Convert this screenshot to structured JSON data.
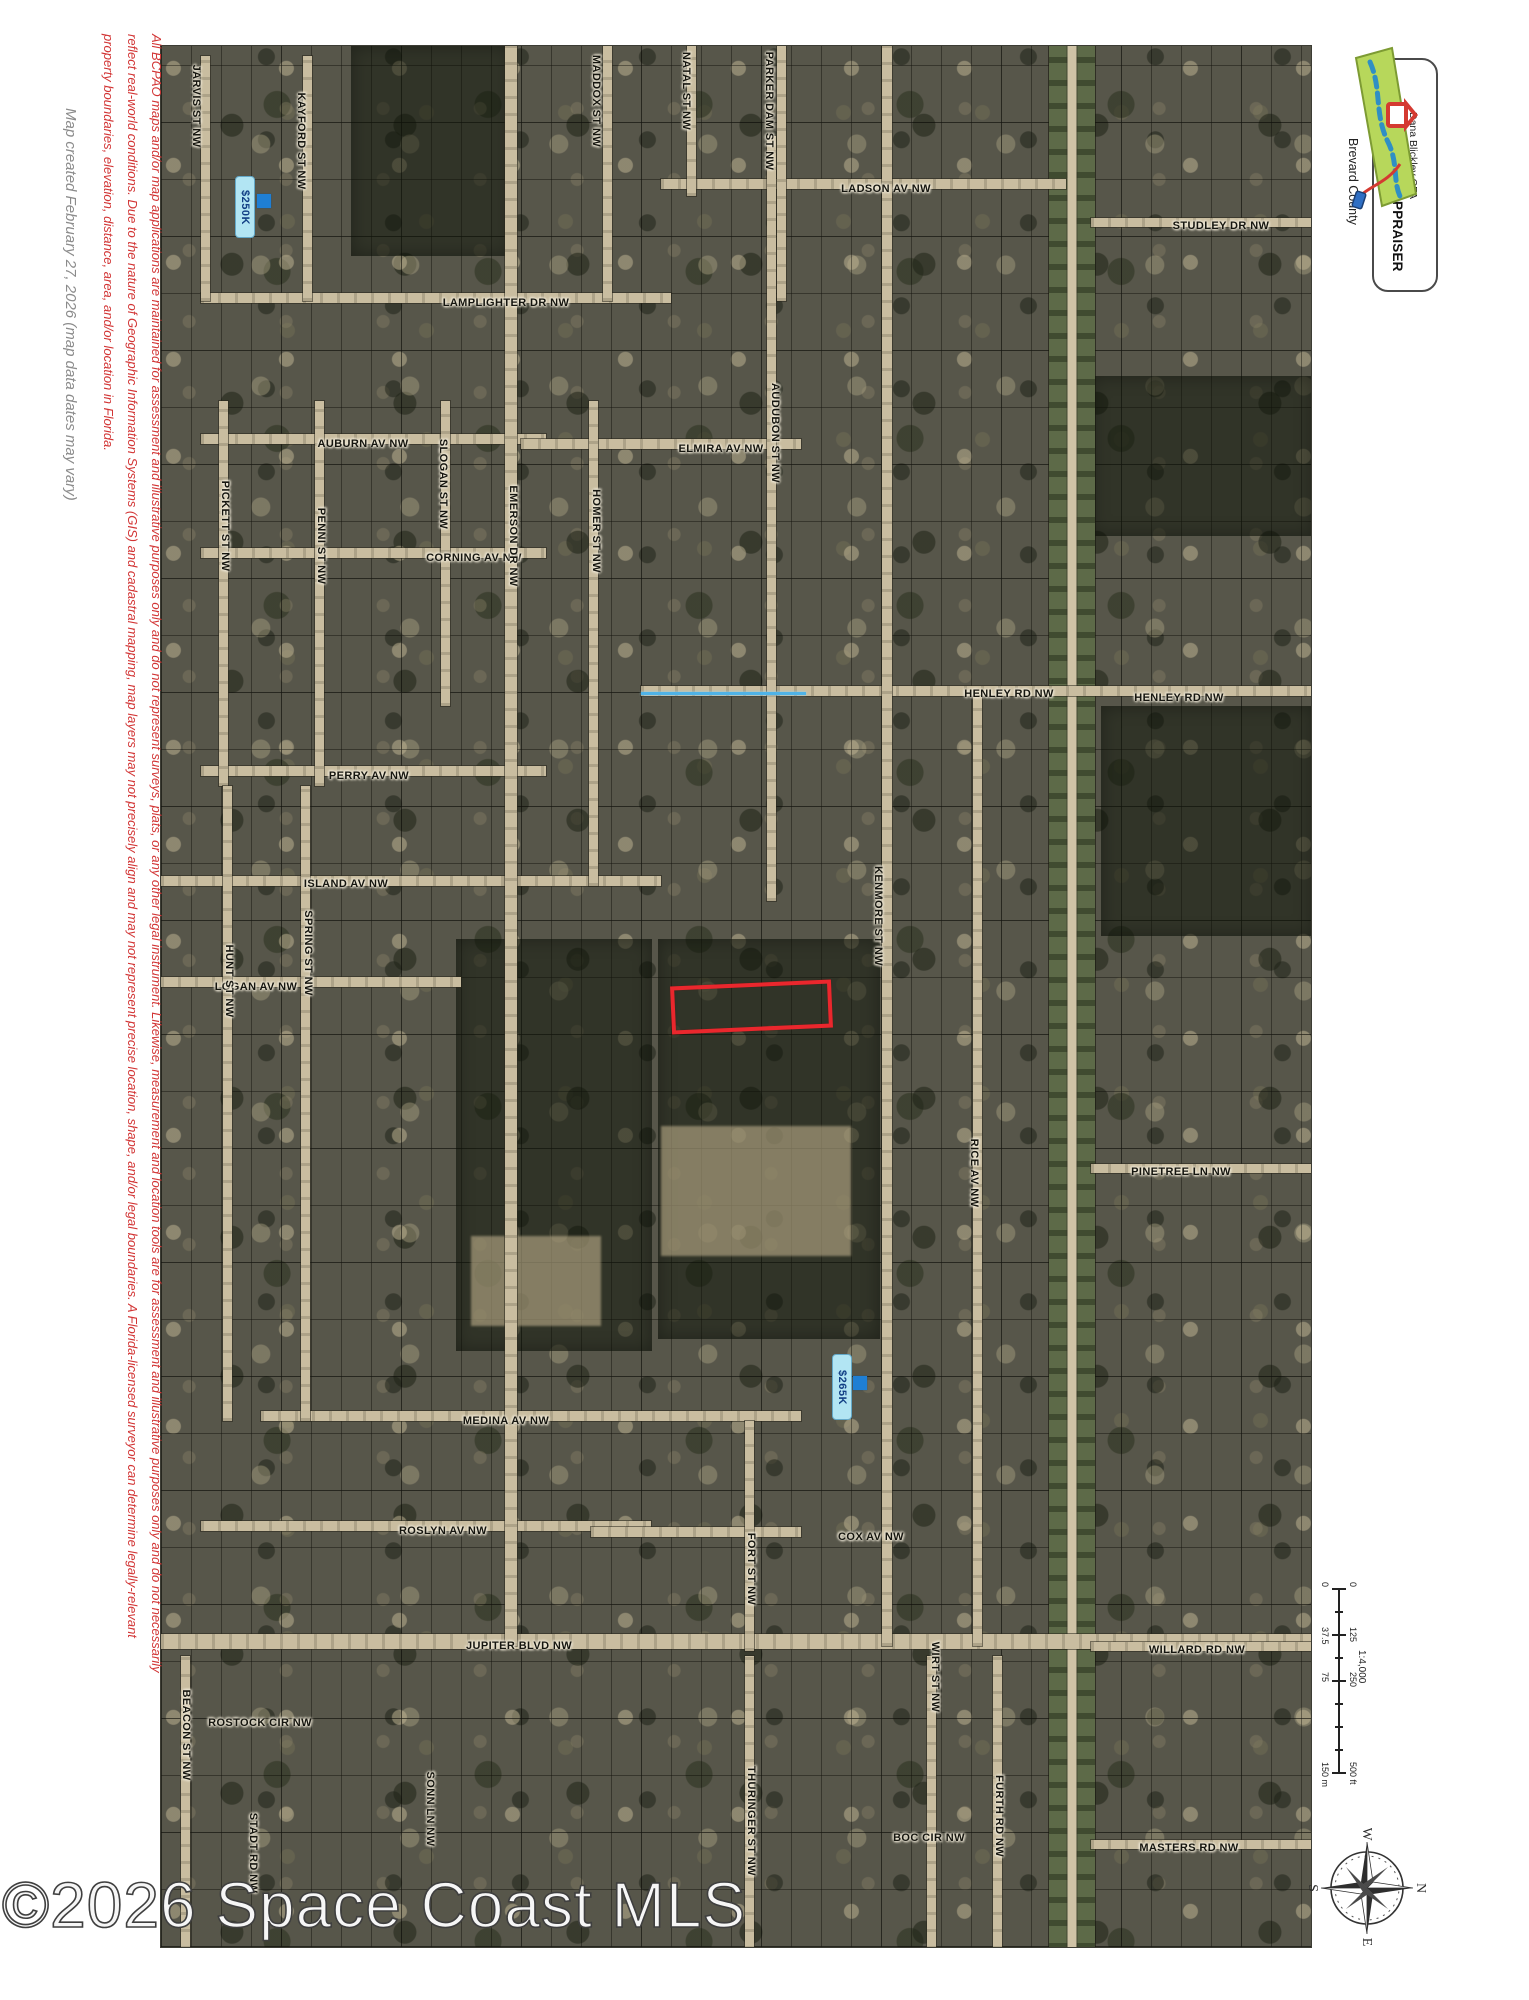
{
  "watermark": "©2026 Space Coast MLS",
  "left_margin": {
    "map_created": "Map created February 27, 2026 (map data dates may vary)",
    "disclaimer": "All BCPAO maps and/or map applications are maintained for assessment and illustrative purposes only and do not represent surveys, plats, or any other legal instrument. Likewise, measurement and location tools are for assessment and illustrative purposes only and do not necessarily reflect real-world conditions. Due to the nature of Geographic Information Systems (GIS) and cadastral mapping, map layers may not precisely align and may not represent precise location, shape, and/or legal boundaries. A Florida-licensed surveyor can determine legally-relevant property boundaries, elevation, distance, area, and/or location in Florida."
  },
  "logo": {
    "name_line": "Dana Blickley CFA",
    "title_line": "PROPERTY APPRAISER",
    "county_line": "Brevard County"
  },
  "scale_bar": {
    "ratio": "1:4,000",
    "feet_labels": [
      "0",
      "125",
      "250",
      "500 ft"
    ],
    "meter_labels": [
      "0",
      "37.5",
      "75",
      "150 m"
    ],
    "label_offsets": [
      0,
      45,
      90,
      180
    ]
  },
  "compass": {
    "north": "N",
    "east": "E",
    "south": "S",
    "west": "W"
  },
  "map": {
    "subject_parcel": {
      "x": 510,
      "y": 937,
      "w": 153,
      "h": 40,
      "color": "#ea272d"
    },
    "waterway": {
      "x": 480,
      "y": 646,
      "len": 165,
      "color": "#4fb3e8"
    },
    "price_markers": [
      {
        "label": "$250K",
        "x": 74,
        "y": 130,
        "w": 18,
        "h": 60,
        "dot_x": 96,
        "dot_y": 148,
        "dot_s": 14
      },
      {
        "label": "$265K",
        "x": 671,
        "y": 1308,
        "w": 18,
        "h": 64,
        "dot_x": 692,
        "dot_y": 1330,
        "dot_s": 14
      }
    ],
    "street_labels_horizontal": [
      {
        "text": "LADSON AV NW",
        "x": 725,
        "y": 143
      },
      {
        "text": "STUDLEY DR NW",
        "x": 1060,
        "y": 180
      },
      {
        "text": "LAMPLIGHTER DR NW",
        "x": 345,
        "y": 257
      },
      {
        "text": "AUBURN AV NW",
        "x": 202,
        "y": 398
      },
      {
        "text": "ELMIRA AV NW",
        "x": 560,
        "y": 403
      },
      {
        "text": "CORNING AV NW",
        "x": 313,
        "y": 512
      },
      {
        "text": "HENLEY RD NW",
        "x": 848,
        "y": 648
      },
      {
        "text": "HENLEY RD NW",
        "x": 1018,
        "y": 652
      },
      {
        "text": "PERRY AV NW",
        "x": 208,
        "y": 730
      },
      {
        "text": "ISLAND AV NW",
        "x": 185,
        "y": 838
      },
      {
        "text": "LOGAN AV NW",
        "x": 95,
        "y": 941
      },
      {
        "text": "PINETREE LN NW",
        "x": 1020,
        "y": 1126
      },
      {
        "text": "MEDINA AV NW",
        "x": 345,
        "y": 1375
      },
      {
        "text": "ROSLYN AV NW",
        "x": 282,
        "y": 1485
      },
      {
        "text": "COX AV NW",
        "x": 710,
        "y": 1491
      },
      {
        "text": "JUPITER BLVD NW",
        "x": 358,
        "y": 1600
      },
      {
        "text": "WILLARD RD NW",
        "x": 1036,
        "y": 1604
      },
      {
        "text": "ROSTOCK CIR NW",
        "x": 99,
        "y": 1677
      },
      {
        "text": "BOC CIR NW",
        "x": 768,
        "y": 1792
      },
      {
        "text": "MASTERS RD NW",
        "x": 1028,
        "y": 1802
      }
    ],
    "street_labels_vertical": [
      {
        "text": "JARVIS ST NW",
        "x": 35,
        "y": 60
      },
      {
        "text": "KAYFORD ST NW",
        "x": 140,
        "y": 95
      },
      {
        "text": "MADDOX ST NW",
        "x": 435,
        "y": 55
      },
      {
        "text": "NATAL ST NW",
        "x": 525,
        "y": 45
      },
      {
        "text": "PARKER DAM ST NW",
        "x": 608,
        "y": 65
      },
      {
        "text": "EMERSON DR NW",
        "x": 352,
        "y": 490
      },
      {
        "text": "HOMER ST NW",
        "x": 435,
        "y": 485
      },
      {
        "text": "SLOGAN ST NW",
        "x": 282,
        "y": 438
      },
      {
        "text": "AUDUBON ST NW",
        "x": 614,
        "y": 387
      },
      {
        "text": "PICKETT ST NW",
        "x": 64,
        "y": 480
      },
      {
        "text": "PENNI ST NW",
        "x": 160,
        "y": 500
      },
      {
        "text": "SPRING ST NW",
        "x": 147,
        "y": 907
      },
      {
        "text": "HUNT ST NW",
        "x": 68,
        "y": 935
      },
      {
        "text": "KENMORE ST NW",
        "x": 717,
        "y": 870
      },
      {
        "text": "RICE AV NW",
        "x": 813,
        "y": 1127
      },
      {
        "text": "FORT ST NW",
        "x": 590,
        "y": 1523
      },
      {
        "text": "WIRT ST NW",
        "x": 774,
        "y": 1631
      },
      {
        "text": "THURINGER ST NW",
        "x": 590,
        "y": 1775
      },
      {
        "text": "FURTH RD NW",
        "x": 838,
        "y": 1770
      },
      {
        "text": "BEACON ST NW",
        "x": 25,
        "y": 1689
      },
      {
        "text": "SONN LN NW",
        "x": 269,
        "y": 1763
      },
      {
        "text": "STADT RD NW",
        "x": 92,
        "y": 1807
      }
    ],
    "roads_horizontal": [
      {
        "x": 500,
        "y": 138,
        "len": 405,
        "w": 10
      },
      {
        "x": 930,
        "y": 176,
        "len": 222,
        "w": 9
      },
      {
        "x": 40,
        "y": 252,
        "len": 470,
        "w": 10
      },
      {
        "x": 40,
        "y": 393,
        "len": 345,
        "w": 10
      },
      {
        "x": 360,
        "y": 398,
        "len": 280,
        "w": 10
      },
      {
        "x": 40,
        "y": 507,
        "len": 345,
        "w": 10
      },
      {
        "x": 480,
        "y": 645,
        "len": 672,
        "w": 10
      },
      {
        "x": 40,
        "y": 725,
        "len": 345,
        "w": 10
      },
      {
        "x": 0,
        "y": 835,
        "len": 500,
        "w": 10
      },
      {
        "x": 0,
        "y": 936,
        "len": 300,
        "w": 10
      },
      {
        "x": 930,
        "y": 1122,
        "len": 222,
        "w": 9
      },
      {
        "x": 100,
        "y": 1370,
        "len": 540,
        "w": 10
      },
      {
        "x": 40,
        "y": 1480,
        "len": 450,
        "w": 10
      },
      {
        "x": 430,
        "y": 1486,
        "len": 210,
        "w": 10
      },
      {
        "x": 0,
        "y": 1595,
        "len": 1152,
        "w": 15
      },
      {
        "x": 930,
        "y": 1600,
        "len": 222,
        "w": 9
      },
      {
        "x": 930,
        "y": 1798,
        "len": 222,
        "w": 9
      }
    ],
    "roads_vertical": [
      {
        "x": 44,
        "y": 10,
        "len": 245,
        "w": 9
      },
      {
        "x": 146,
        "y": 10,
        "len": 245,
        "w": 9
      },
      {
        "x": 446,
        "y": 0,
        "len": 255,
        "w": 9
      },
      {
        "x": 530,
        "y": 0,
        "len": 150,
        "w": 9
      },
      {
        "x": 620,
        "y": 0,
        "len": 255,
        "w": 9
      },
      {
        "x": 350,
        "y": 0,
        "len": 1600,
        "w": 12
      },
      {
        "x": 432,
        "y": 355,
        "len": 485,
        "w": 9
      },
      {
        "x": 284,
        "y": 355,
        "len": 305,
        "w": 9
      },
      {
        "x": 62,
        "y": 355,
        "len": 385,
        "w": 9
      },
      {
        "x": 158,
        "y": 355,
        "len": 385,
        "w": 9
      },
      {
        "x": 610,
        "y": 90,
        "len": 765,
        "w": 9
      },
      {
        "x": 144,
        "y": 740,
        "len": 635,
        "w": 9
      },
      {
        "x": 66,
        "y": 740,
        "len": 635,
        "w": 9
      },
      {
        "x": 726,
        "y": 0,
        "len": 1600,
        "w": 10
      },
      {
        "x": 816,
        "y": 650,
        "len": 950,
        "w": 9
      },
      {
        "x": 588,
        "y": 1375,
        "len": 230,
        "w": 9
      },
      {
        "x": 770,
        "y": 1610,
        "len": 293,
        "w": 9
      },
      {
        "x": 588,
        "y": 1610,
        "len": 293,
        "w": 9
      },
      {
        "x": 836,
        "y": 1610,
        "len": 293,
        "w": 9
      },
      {
        "x": 24,
        "y": 1610,
        "len": 293,
        "w": 9
      }
    ],
    "corridor": {
      "x": 888,
      "y": 0,
      "w": 46,
      "len": 1903
    },
    "wooded_blocks": [
      {
        "x": 295,
        "y": 893,
        "w": 196,
        "h": 412
      },
      {
        "x": 497,
        "y": 893,
        "w": 222,
        "h": 400
      },
      {
        "x": 930,
        "y": 330,
        "w": 222,
        "h": 160
      },
      {
        "x": 190,
        "y": 0,
        "w": 160,
        "h": 210
      },
      {
        "x": 940,
        "y": 660,
        "w": 212,
        "h": 230
      }
    ],
    "clearings": [
      {
        "x": 500,
        "y": 1080,
        "w": 190,
        "h": 130
      },
      {
        "x": 310,
        "y": 1190,
        "w": 130,
        "h": 90
      }
    ]
  }
}
